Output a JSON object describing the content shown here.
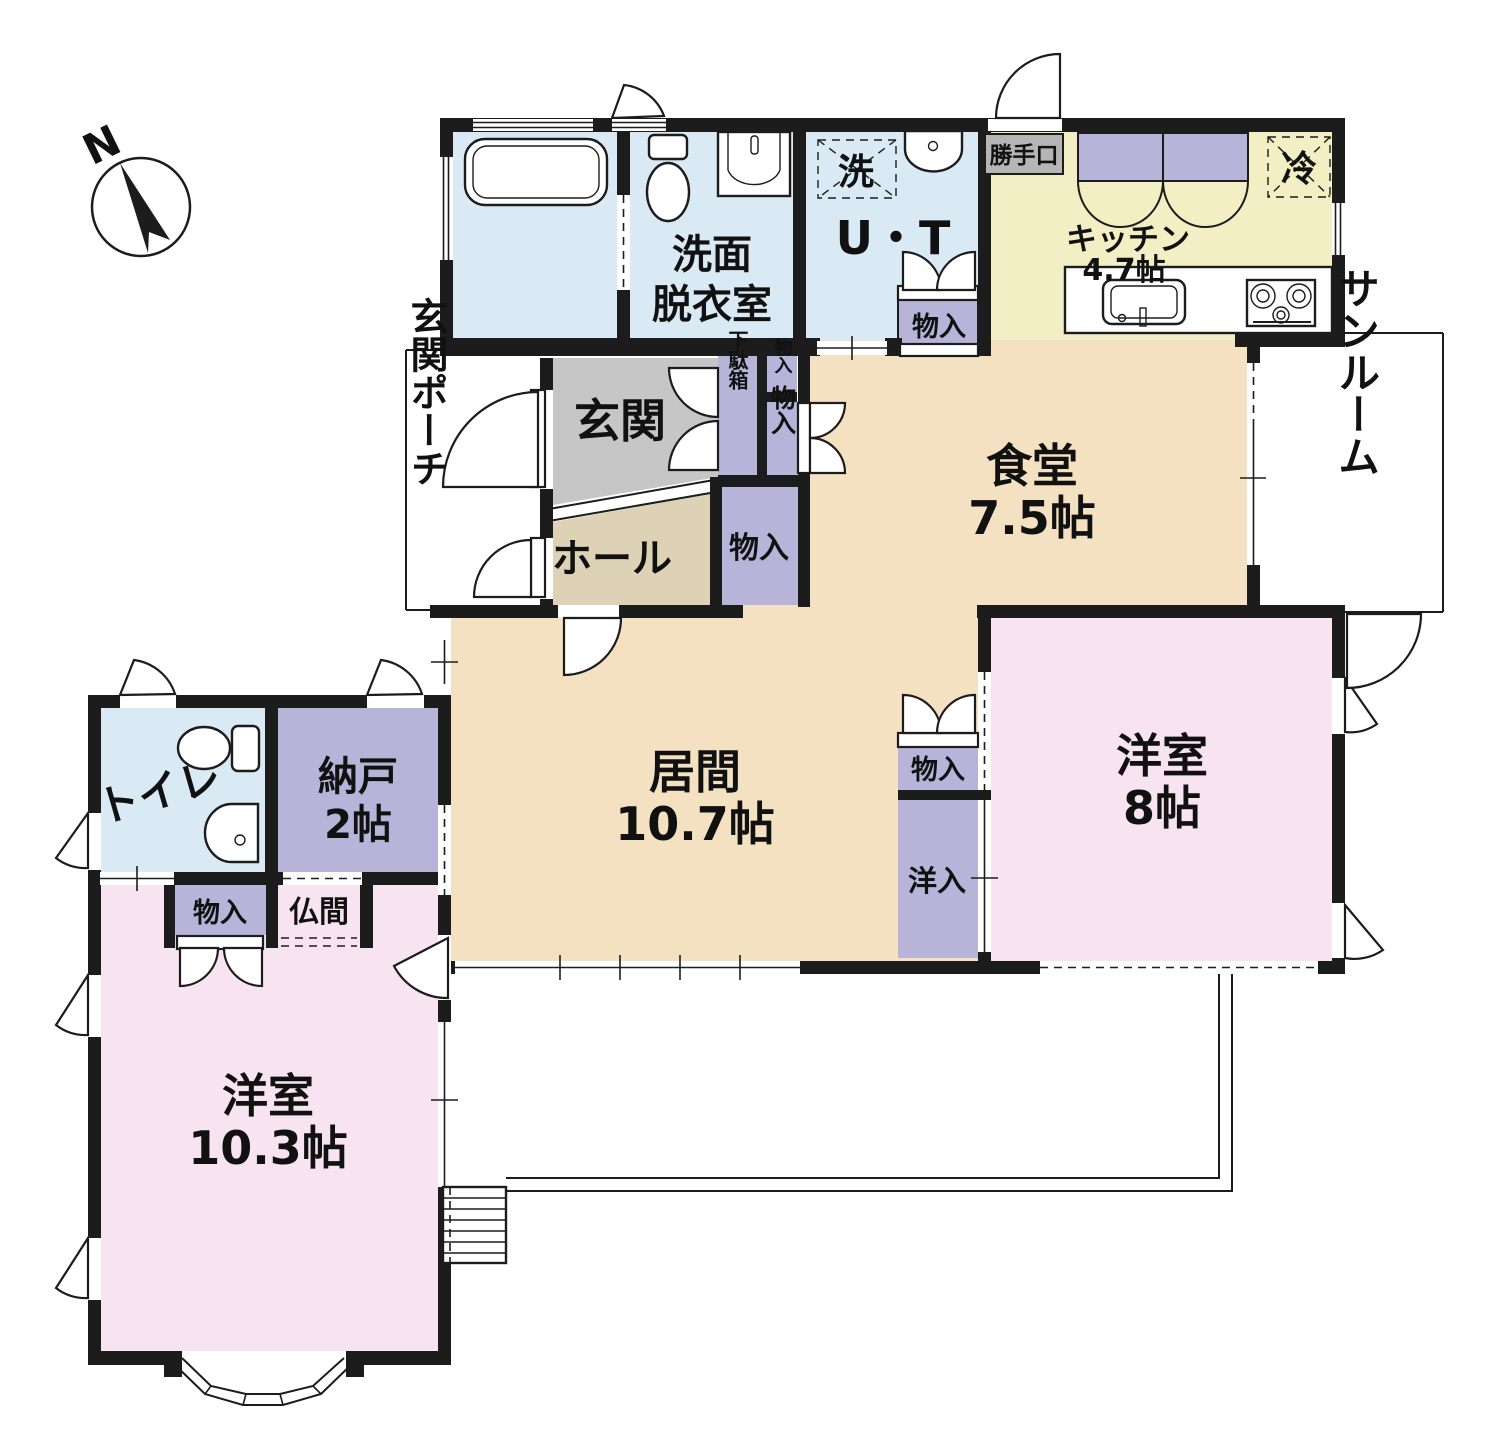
{
  "compass": {
    "north": "N"
  },
  "rooms": {
    "washroom": {
      "line1": "洗面",
      "line2": "脱衣室"
    },
    "utility": {
      "name": "U・T"
    },
    "kitchen": {
      "name": "キッチン",
      "size": "4.7帖"
    },
    "dining": {
      "name": "食堂",
      "size": "7.5帖"
    },
    "sunroom": {
      "name": "サンルーム"
    },
    "genkan": {
      "name": "玄関"
    },
    "porch": {
      "name": "玄関ポーチ"
    },
    "hall": {
      "name": "ホール"
    },
    "living": {
      "name": "居間",
      "size": "10.7帖"
    },
    "western8": {
      "name": "洋室",
      "size": "8帖"
    },
    "toilet": {
      "name": "トイレ"
    },
    "nando": {
      "name": "納戸",
      "size": "2帖"
    },
    "butsuma": {
      "name": "仏間"
    },
    "western10": {
      "name": "洋室",
      "size": "10.3帖"
    }
  },
  "closets": {
    "ut_closet": "物入",
    "genkan_closet_small": "物入",
    "genkan_closet_tall": "物入",
    "shoe_cabinet": "下駄箱",
    "hall_closet": "物入",
    "living_closet": "物入",
    "west_closet": "洋入",
    "toilet_closet": "物入"
  },
  "fixtures": {
    "washer": "洗",
    "fridge": "冷",
    "back_door": "勝手口"
  },
  "colors": {
    "wall": "#1c1c1c",
    "water_blue": "#d9eaf4",
    "kitchen_yellow": "#f3efc5",
    "wood_tan": "#f3e1c1",
    "hall_tan": "#ddd2b5",
    "genkan_gray": "#c6c6c6",
    "room_pink": "#f8e3f1",
    "closet_purple": "#b8b3d8",
    "label_gray": "#b5b5b5"
  }
}
